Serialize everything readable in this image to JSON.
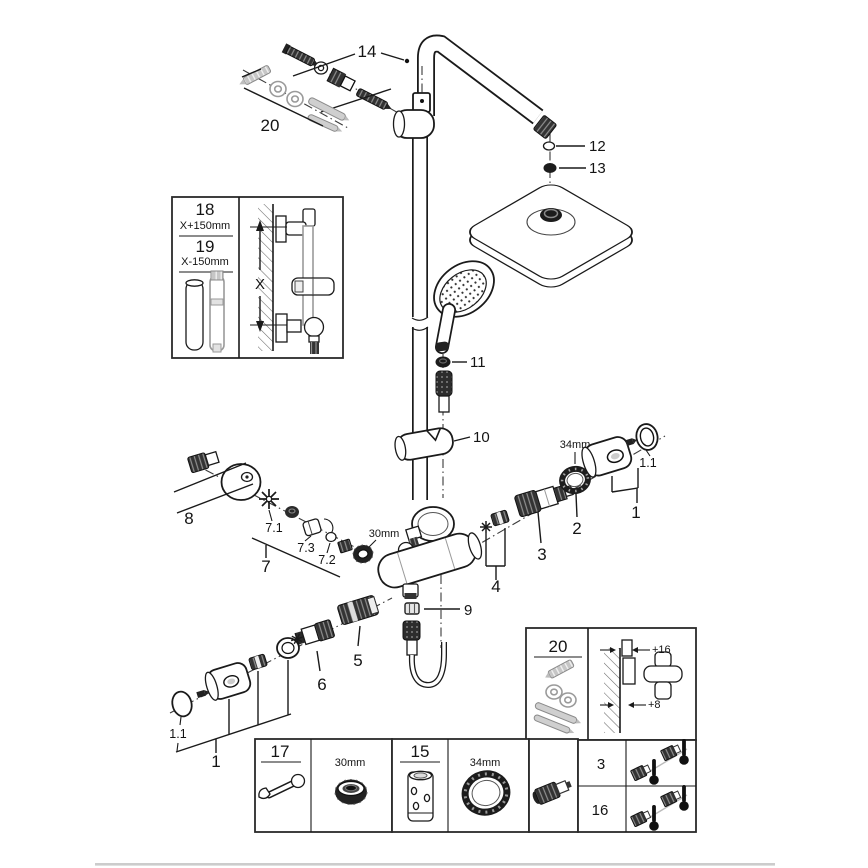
{
  "labels": {
    "part14": "14",
    "part20_top": "20",
    "part12": "12",
    "part13": "13",
    "part11": "11",
    "part10": "10",
    "part9": "9",
    "part8": "8",
    "part7_1": "7.1",
    "part7_3": "7.3",
    "part7_2": "7.2",
    "part7": "7",
    "nut_size_30mm": "30mm",
    "ring_size_34mm": "34mm",
    "part2": "2",
    "part1_right": "1",
    "part1_1_right": "1.1",
    "part3": "3",
    "part4": "4",
    "part5": "5",
    "part6": "6",
    "part1_1_left": "1.1",
    "part1_left": "1"
  },
  "inset_length": {
    "part18": "18",
    "part18_dim": "X+150mm",
    "part19": "19",
    "part19_dim": "X-150mm",
    "x_dim": "X"
  },
  "inset_mounting": {
    "label": "20",
    "top_offset": "+16",
    "bottom_offset": "+8"
  },
  "tools_table": {
    "wrench_label": "17",
    "wrench_size": "30mm",
    "sleeve_label": "15",
    "ring_size": "34mm"
  },
  "variants_table": {
    "row1": "3",
    "row2": "16"
  },
  "colors": {
    "line": "#1a1a1a",
    "gray_part": "#b5b5b5",
    "footer_divider": "#cccccc"
  }
}
